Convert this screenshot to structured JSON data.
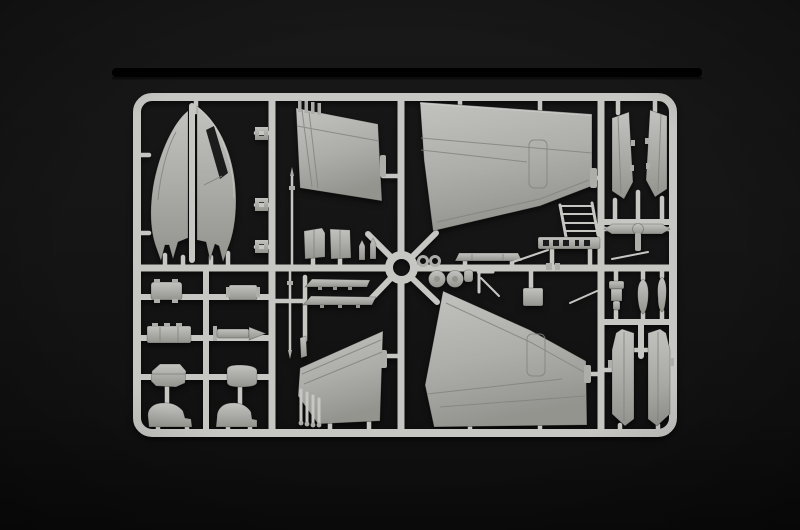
{
  "photo": {
    "description": "Injection-molded model kit sprue of light gray aircraft parts photographed on a black background with a black shelf edge above"
  },
  "colors": {
    "bg-top": "#181818",
    "bg-mid": "#151515",
    "bg-low": "#111111",
    "bg-bottom": "#0b0b0b",
    "stripe": "#000000",
    "runner": "#c6c7c3",
    "runner-deep": "#9a9b97",
    "part-light": "#c2c2bf",
    "part-mid": "#adadaa",
    "part-dark": "#94948f",
    "panel-line": "#83837f",
    "edge-dark": "#55554f",
    "slot": "#1c1c1c"
  },
  "part_labels": {
    "fuselage-half-left": "fuselage half (left)",
    "fuselage-half-right": "fuselage half (right)",
    "wing-outer-upper": "outer wing panel (upper)",
    "wing-inner-upper": "inner wing panel (upper)",
    "wing-outer-lower": "outer wing panel (lower)",
    "wing-inner-lower": "inner wing panel (lower)",
    "fin-half-left": "vertical fin half (left)",
    "fin-half-right": "vertical fin half (right)",
    "stabilator-assembly": "stabilator with actuator",
    "drop-tank-halves": "drop tank halves",
    "seat-part": "ejection seat / strut block",
    "intake-ramp-left": "intake ramp (left)",
    "intake-ramp-right": "intake ramp (right)",
    "boarding-ladder": "boarding ladder",
    "vent-grate": "slotted vent grate",
    "main-wheels": "main wheels",
    "gear-leg": "landing gear leg",
    "equipment-box-1": "equipment box",
    "equipment-box-2": "equipment box (small)",
    "equipment-box-long": "long equipment box",
    "missile": "missile / fuel probe body",
    "pod-angular": "angular pod",
    "pod-round": "rounded pod",
    "fairing-left": "nacelle fairing (left)",
    "fairing-right": "nacelle fairing (right)",
    "intake-trunk-a": "intake trunk part",
    "intake-trunk-b": "intake trunk part",
    "pitot-probe-upper": "pitot probe (upper)",
    "pitot-probe-lower": "pitot probe (lower)",
    "flap-strip-1": "flap strip",
    "flap-strip-2": "flap strip",
    "hub-ring": "sprue hub ring part",
    "canopy-sill": "canopy sill strip",
    "small-brackets": "small brackets"
  }
}
